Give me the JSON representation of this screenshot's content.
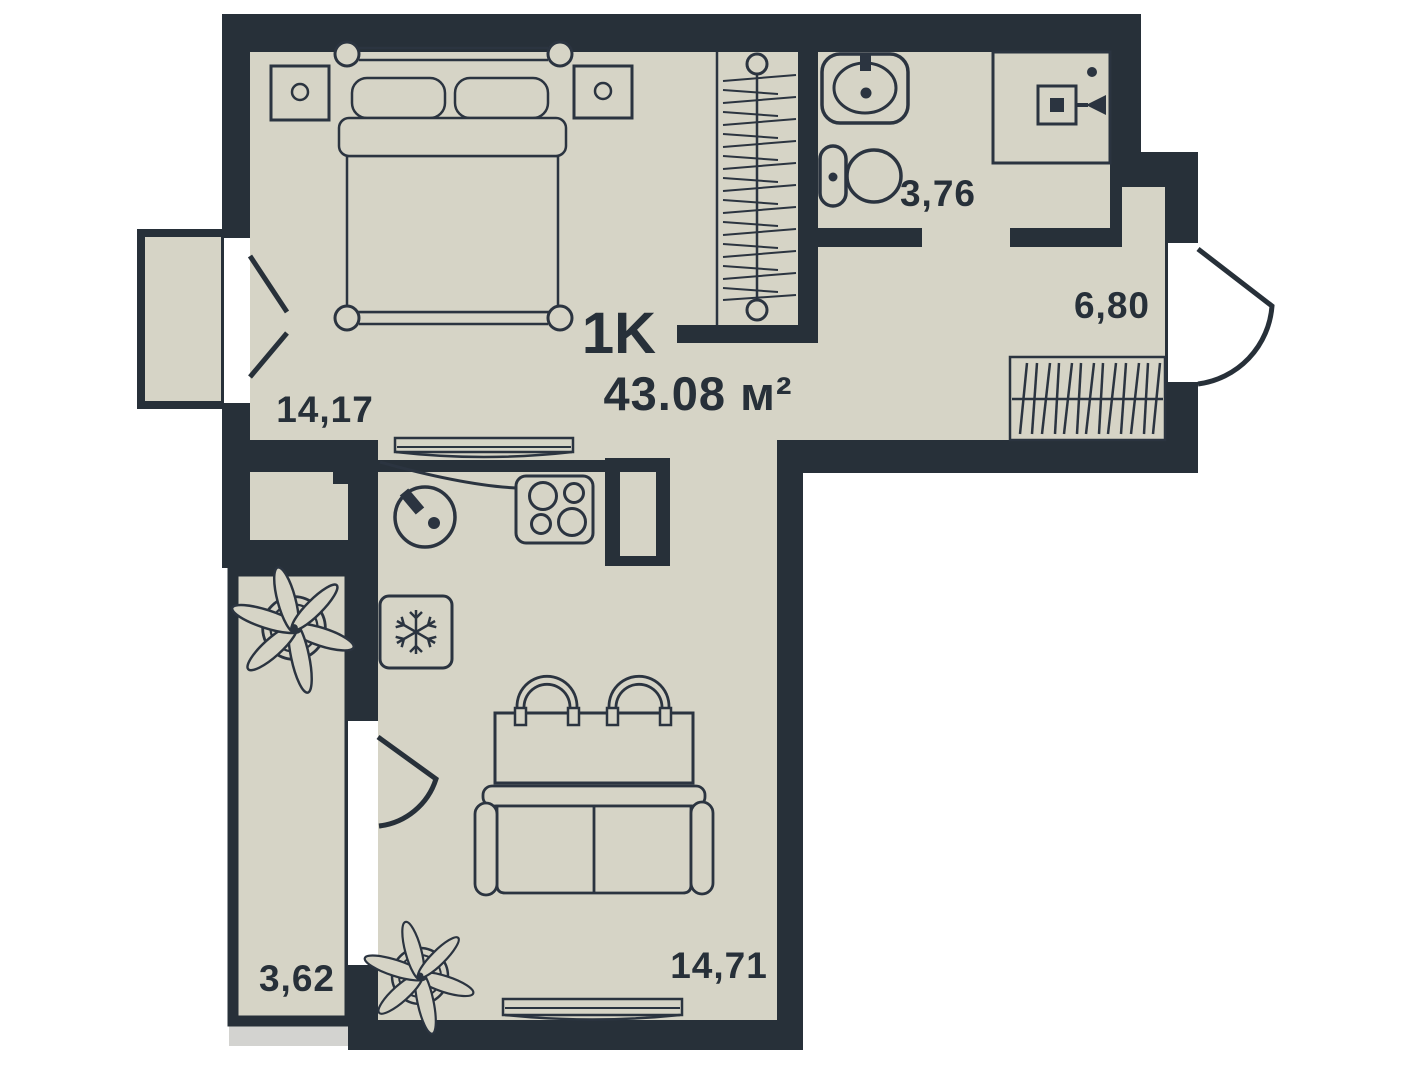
{
  "plan": {
    "type_label": "1K",
    "total_area": "43.08 м²",
    "rooms": [
      {
        "name": "bedroom",
        "area": "14,17"
      },
      {
        "name": "bathroom",
        "area": "3,76"
      },
      {
        "name": "hallway",
        "area": "6,80"
      },
      {
        "name": "kitchen-living-room",
        "area": "14,71"
      },
      {
        "name": "balcony",
        "area": "3,62"
      }
    ],
    "colors": {
      "wall": "#273039",
      "floor": "#d6d4c6",
      "background": "#ffffff",
      "shadow": "#d3d3d0",
      "line": "#2b3440"
    }
  }
}
